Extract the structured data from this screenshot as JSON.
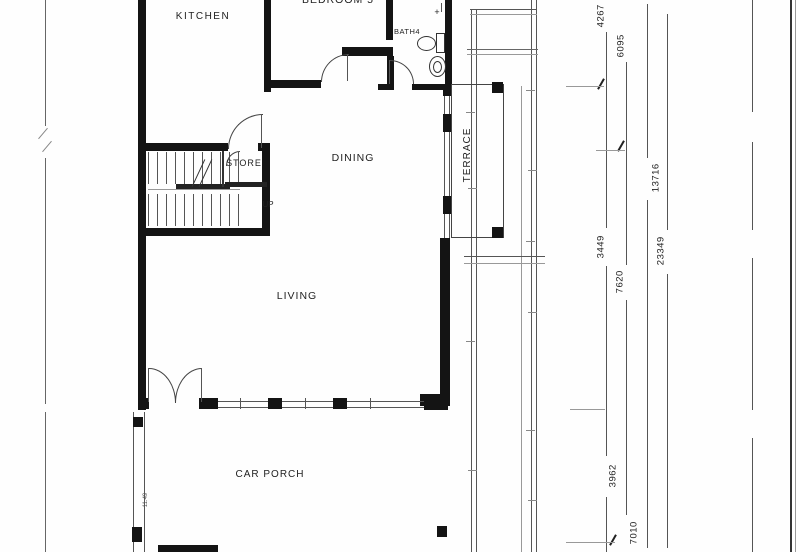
{
  "plan": {
    "rooms": {
      "kitchen": "KITCHEN",
      "bedroom5": "BEDROOM 5",
      "bath": "BATH4",
      "store": "STORE",
      "stairs_up": "UP",
      "dining": "DINING",
      "terrace": "TERRACE",
      "living": "LIVING",
      "car_porch": "CAR PORCH"
    },
    "dimensions": [
      {
        "value": "4267"
      },
      {
        "value": "6095"
      },
      {
        "value": "13716"
      },
      {
        "value": "23349"
      },
      {
        "value": "3449"
      },
      {
        "value": "7620"
      },
      {
        "value": "3962"
      },
      {
        "value": "7010"
      }
    ],
    "small_annotation": "11.49",
    "icons": {
      "shower_plus": "+"
    },
    "colors": {
      "wall": "#141414",
      "line": "#555555",
      "text": "#222222",
      "background": "#fefefe"
    }
  }
}
